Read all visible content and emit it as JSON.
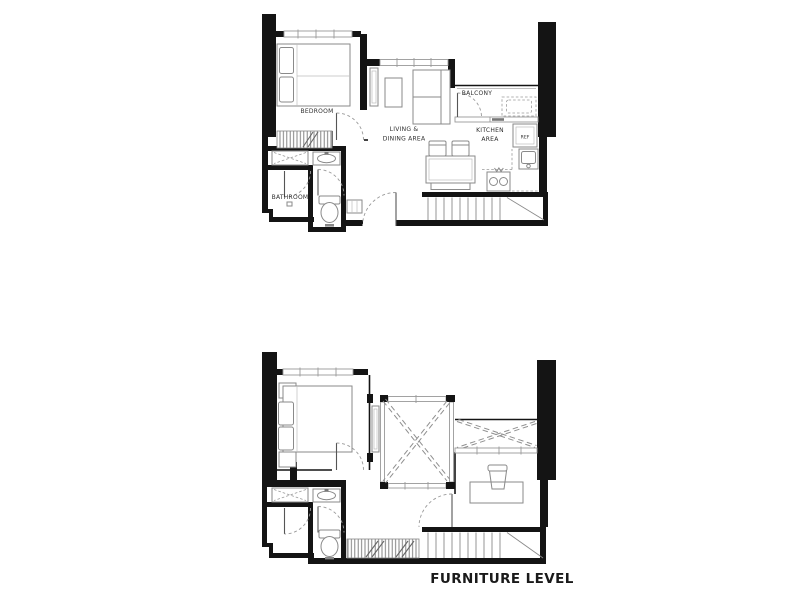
{
  "caption": {
    "furniture_level": "FURNITURE LEVEL"
  },
  "colors": {
    "background": "#ffffff",
    "wall": "#141414",
    "thin_line": "#444444",
    "furniture_line": "#8a8a8a",
    "window_line": "#999999",
    "dashed_line": "#9a9a9a",
    "label_text": "#2f2f2f"
  },
  "plan_upper": {
    "name": "upper-level-plan",
    "labels": {
      "bedroom": "BEDROOM",
      "living_line1": "LIVING &",
      "living_line2": "DINING AREA",
      "kitchen_line1": "KITCHEN",
      "kitchen_line2": "AREA",
      "balcony": "BALCONY",
      "bathroom": "BATHROOM",
      "ref": "REF"
    }
  },
  "plan_furniture": {
    "name": "furniture-level-plan",
    "caption": "FURNITURE LEVEL"
  }
}
